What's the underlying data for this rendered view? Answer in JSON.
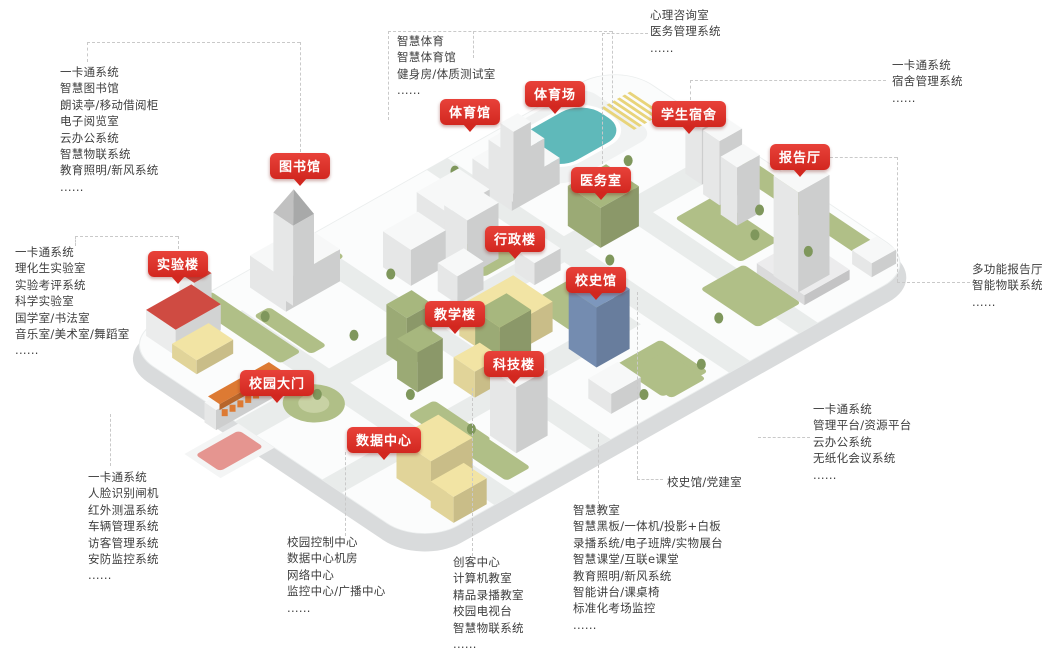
{
  "palette": {
    "badge_red": "#e8423a",
    "badge_red_dark": "#d2271f",
    "badge_text": "#ffffff",
    "text": "#3e3e3e",
    "line": "#c9c9c9",
    "platform": "#fbfcfc",
    "platform_side": "#d9dbdc",
    "road": "#e9eceb",
    "lawn": "#b0bf87",
    "lawn_light": "#c8d2a4",
    "tree": "#7f975c",
    "pool": "#5fb9ba",
    "pool_deck": "#f0f2f2",
    "track_stripe": "#e8d47b",
    "ramp": "#f4f5f5",
    "ramp_inner": "#e59590",
    "buildings": {
      "white": "#f7f8f8",
      "yellow": "#f2e4a4",
      "green": "#a7b77e",
      "blue": "#7d97bd",
      "red": "#cf4b42",
      "gray": "#ececed",
      "orange": "#dd7a33"
    }
  },
  "badges": {
    "library": "图书馆",
    "gym": "体育馆",
    "stadium": "体育场",
    "dorm": "学生宿舍",
    "hall": "报告厅",
    "medical": "医务室",
    "admin": "行政楼",
    "history": "校史馆",
    "teaching": "教学楼",
    "tech": "科技楼",
    "lab": "实验楼",
    "gate": "校园大门",
    "datacenter": "数据中心"
  },
  "callout_label": "校史馆/党建室",
  "lists": {
    "library": [
      "一卡通系统",
      "智慧图书馆",
      "朗读亭/移动借阅柜",
      "电子阅览室",
      "云办公系统",
      "智慧物联系统",
      "教育照明/新风系统",
      "......"
    ],
    "lab": [
      "一卡通系统",
      "理化生实验室",
      "实验考评系统",
      "科学实验室",
      "国学室/书法室",
      "音乐室/美术室/舞蹈室",
      "......"
    ],
    "gate": [
      "一卡通系统",
      "人脸识别闸机",
      "红外测温系统",
      "车辆管理系统",
      "访客管理系统",
      "安防监控系统",
      "......"
    ],
    "sports": [
      "智慧体育",
      "智慧体育馆",
      "健身房/体质测试室",
      "......"
    ],
    "medical": [
      "心理咨询室",
      "医务管理系统",
      "......"
    ],
    "dorm": [
      "一卡通系统",
      "宿舍管理系统",
      "......"
    ],
    "hall": [
      "多功能报告厅",
      "智能物联系统",
      "......"
    ],
    "admin": [
      "一卡通系统",
      "管理平台/资源平台",
      "云办公系统",
      "无纸化会议系统",
      "......"
    ],
    "datacenter": [
      "校园控制中心",
      "数据中心机房",
      "网络中心",
      "监控中心/广播中心",
      "......"
    ],
    "maker": [
      "创客中心",
      "计算机教室",
      "精品录播教室",
      "校园电视台",
      "智慧物联系统",
      "......"
    ],
    "classroom": [
      "智慧教室",
      "智慧黑板/一体机/投影+白板",
      "录播系统/电子班牌/实物展台",
      "智慧课堂/互联e课堂",
      "教育照明/新风系统",
      "智能讲台/课桌椅",
      "标准化考场监控",
      "......"
    ]
  }
}
